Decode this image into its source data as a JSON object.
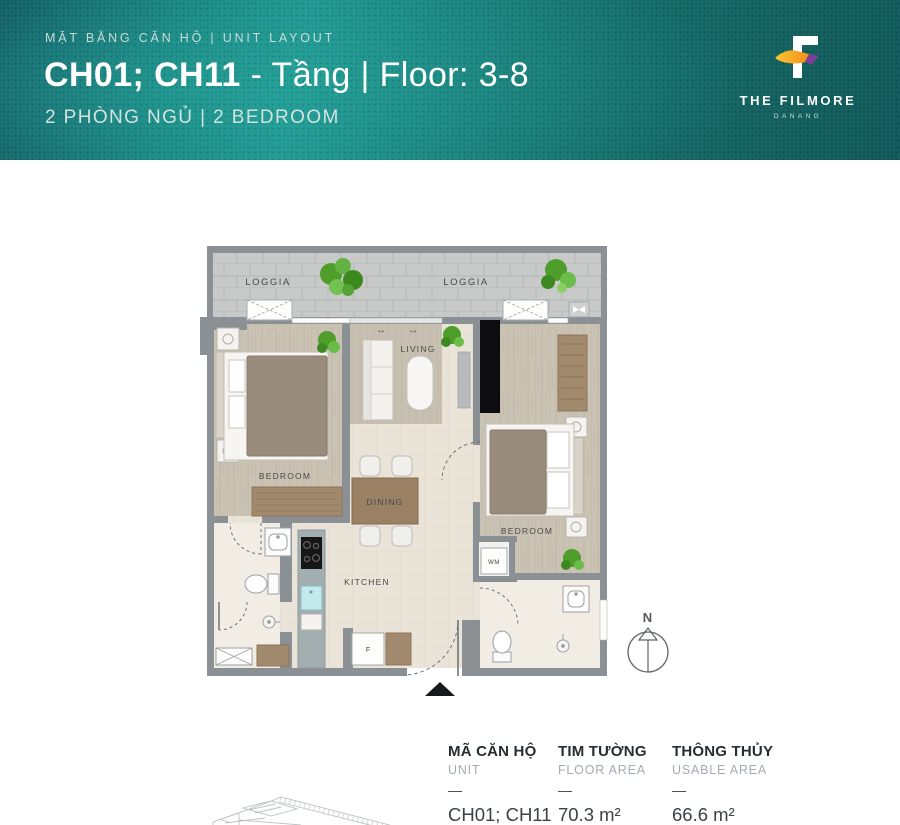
{
  "header": {
    "eyebrow": "MẶT BẰNG CĂN HỘ | UNIT LAYOUT",
    "title_bold": "CH01; CH11",
    "title_rest": " - Tầng | Floor: 3-8",
    "subtitle": "2 PHÒNG NGỦ | 2 BEDROOM",
    "logo": {
      "name": "THE FILMORE",
      "city": "DANANG"
    }
  },
  "floor_plan": {
    "labels": {
      "loggia_left": "LOGGIA",
      "loggia_right": "LOGGIA",
      "living": "LIVING",
      "bedroom_left": "BEDROOM",
      "bedroom_right": "BEDROOM",
      "dining": "DINING",
      "kitchen": "KITCHEN",
      "washer": "WM",
      "fridge": "F",
      "compass_north": "N",
      "slide_arrow": "↔"
    }
  },
  "info_table": {
    "columns": [
      {
        "label_vi": "MÃ CĂN HỘ",
        "label_en": "UNIT",
        "divider": "—",
        "value": "CH01; CH11"
      },
      {
        "label_vi": "TIM TƯỜNG",
        "label_en": "FLOOR AREA",
        "divider": "—",
        "value": "70.3 m²"
      },
      {
        "label_vi": "THÔNG THỦY",
        "label_en": "USABLE AREA",
        "divider": "—",
        "value": "66.6 m²"
      }
    ]
  },
  "colors": {
    "header_teal_bright": "#1d938c",
    "header_teal_dark": "#0e4f57",
    "logo_orange": "#f59d1f",
    "logo_purple": "#7d3e98",
    "wall_gray": "#8b9095",
    "wood_floor": "#ccc4b5",
    "tile_floor": "#eae4d8",
    "plant_green": "#4f9e2b"
  }
}
